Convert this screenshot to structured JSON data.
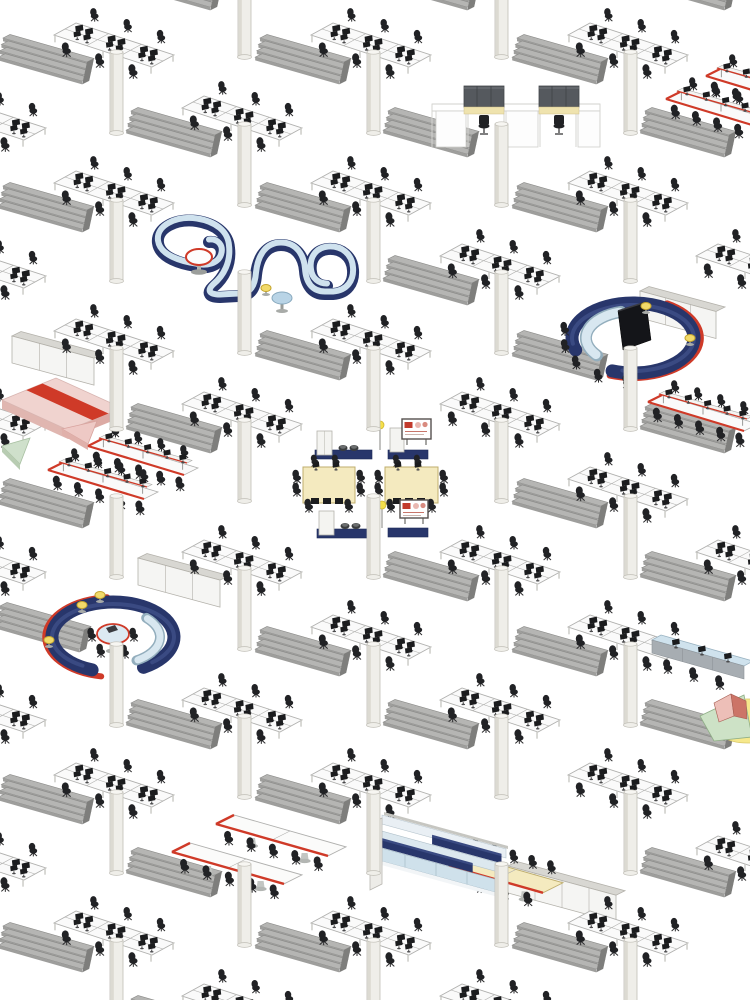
{
  "canvas": {
    "w": 750,
    "h": 1000,
    "bg": "#ffffff"
  },
  "palette": {
    "shelf_top": "#b5b5b3",
    "shelf_front": "#9e9e9c",
    "shelf_cap": "#7e7e7c",
    "shelf_stroke": "#8a8a88",
    "desk_top": "#fafafa",
    "desk_stroke": "#b0b0ae",
    "leg": "#c8c8c4",
    "monitor": "#1b1c1e",
    "chair": "#212225",
    "column_body": "#efeee9",
    "column_shade": "#dcdad2",
    "column_stroke": "#c0beb6",
    "column_top": "#f7f6f2",
    "navy": "#28366b",
    "navy_dark": "#1d2a57",
    "navy_top": "#3a4a82",
    "seat_blue": "#cfe2ed",
    "seat_edge": "#93aebd",
    "seat_light": "#d8e7f0",
    "red": "#cf3a28",
    "cream": "#f4eabf",
    "cream_stroke": "#bfae6e",
    "cabinet_front": "#f5f5f3",
    "cabinet_top": "#d8d7d2",
    "cabinet_stroke": "#b3b1aa",
    "stool_yellow": "#f2da6a",
    "stool_stroke": "#c4a52f",
    "booth_panel": "#55595e",
    "booth_stripe": "#efe3ae",
    "pink": "#f0d3cf",
    "pink_side": "#e0b6b0",
    "green": "#cfe0cb",
    "screen": "#141519",
    "display_red": "#c23b2d",
    "display_pink": "#e9b7b0",
    "lamp": "#f5e04a",
    "bleach_face": "#cfe1eb",
    "bleach_top": "#e9eff4",
    "bleach_mid": "#dce8ef",
    "gray_cap": "#c6c6c1",
    "counter_front": "#a7adb2"
  },
  "scene": {
    "clusters": [
      [
        -14,
        118
      ],
      [
        -14,
        266
      ],
      [
        -14,
        414
      ],
      [
        -14,
        562
      ],
      [
        -14,
        710
      ],
      [
        -14,
        858
      ],
      [
        114,
        45
      ],
      [
        114,
        193
      ],
      [
        114,
        341
      ],
      [
        114,
        785
      ],
      [
        114,
        933
      ],
      [
        242,
        118
      ],
      [
        242,
        414
      ],
      [
        242,
        562
      ],
      [
        242,
        710
      ],
      [
        242,
        1006
      ],
      [
        371,
        45
      ],
      [
        371,
        193
      ],
      [
        371,
        341
      ],
      [
        371,
        637
      ],
      [
        371,
        785
      ],
      [
        371,
        933
      ],
      [
        500,
        266
      ],
      [
        500,
        414
      ],
      [
        500,
        562
      ],
      [
        500,
        710
      ],
      [
        500,
        1006
      ],
      [
        628,
        45
      ],
      [
        628,
        193
      ],
      [
        628,
        489
      ],
      [
        628,
        637
      ],
      [
        628,
        785
      ],
      [
        628,
        933
      ],
      [
        756,
        266
      ],
      [
        756,
        562
      ],
      [
        756,
        858
      ]
    ],
    "shelves": [
      [
        3,
        38
      ],
      [
        3,
        186
      ],
      [
        3,
        482
      ],
      [
        0,
        606
      ],
      [
        3,
        778
      ],
      [
        3,
        926
      ],
      [
        131,
        -36
      ],
      [
        131,
        111
      ],
      [
        131,
        407
      ],
      [
        131,
        703
      ],
      [
        131,
        851
      ],
      [
        131,
        999
      ],
      [
        260,
        38
      ],
      [
        260,
        186
      ],
      [
        260,
        334
      ],
      [
        260,
        630
      ],
      [
        260,
        778
      ],
      [
        260,
        926
      ],
      [
        388,
        -36
      ],
      [
        388,
        111
      ],
      [
        388,
        259
      ],
      [
        388,
        555
      ],
      [
        388,
        703
      ],
      [
        517,
        38
      ],
      [
        517,
        186
      ],
      [
        517,
        334
      ],
      [
        517,
        482
      ],
      [
        517,
        630
      ],
      [
        517,
        926
      ],
      [
        645,
        -36
      ],
      [
        645,
        111
      ],
      [
        645,
        407
      ],
      [
        645,
        555
      ],
      [
        645,
        703
      ],
      [
        645,
        851
      ]
    ],
    "columns": [
      [
        110,
        50
      ],
      [
        110,
        198
      ],
      [
        110,
        346
      ],
      [
        110,
        494
      ],
      [
        110,
        642
      ],
      [
        110,
        790
      ],
      [
        110,
        938
      ],
      [
        238,
        -26
      ],
      [
        238,
        122
      ],
      [
        238,
        270
      ],
      [
        238,
        418
      ],
      [
        238,
        566
      ],
      [
        238,
        714
      ],
      [
        238,
        862
      ],
      [
        367,
        50
      ],
      [
        367,
        198
      ],
      [
        367,
        346
      ],
      [
        367,
        494
      ],
      [
        367,
        642
      ],
      [
        367,
        790
      ],
      [
        367,
        938
      ],
      [
        495,
        -26
      ],
      [
        495,
        122
      ],
      [
        495,
        270
      ],
      [
        495,
        418
      ],
      [
        495,
        566
      ],
      [
        495,
        714
      ],
      [
        495,
        862
      ],
      [
        624,
        50
      ],
      [
        624,
        198
      ],
      [
        624,
        346
      ],
      [
        624,
        494
      ],
      [
        624,
        642
      ],
      [
        624,
        790
      ],
      [
        624,
        938
      ]
    ],
    "cabinets": [
      {
        "x": 12,
        "y": 336,
        "len": 82
      },
      {
        "x": 138,
        "y": 558,
        "len": 82
      },
      {
        "x": 640,
        "y": 291,
        "len": 76
      },
      {
        "x": 508,
        "y": 866,
        "len": 108
      }
    ],
    "s_sofa": {
      "path": "M 209 242 C 218 241 224 248 221 257 C 218 266 206 269 196 266 C 182 264 160 258 158 243 C 156 228 176 218 197 221 C 216 224 228 234 229 248 C 231 264 224 278 213 287 C 207 293 209 297 220 297 L 238 296 C 251 296 255 288 256 275 C 258 256 267 245 281 245 C 296 245 304 257 305 271 C 306 286 313 294 325 294 L 333 294 C 347 293 354 283 353 270 C 352 256 341 248 328 249 C 316 250 309 260 311 272 C 312 281 319 286 327 286",
      "round_table": [
        199,
        257
      ],
      "yellow_stools": [
        [
          266,
          288
        ]
      ],
      "blue_table": [
        282,
        298
      ]
    },
    "ring_right": {
      "cx": 633,
      "cy": 338,
      "rx": 61,
      "ry": 35,
      "screen": [
        [
          618,
          311
        ],
        [
          646,
          302
        ],
        [
          651,
          340
        ],
        [
          623,
          350
        ]
      ],
      "chairs_deg": [
        95,
        120,
        145,
        168,
        190
      ],
      "stools": [
        [
          646,
          306
        ],
        [
          690,
          338
        ]
      ]
    },
    "ring_left": {
      "cx": 113,
      "cy": 637,
      "rx": 61,
      "ry": 35,
      "table": [
        113,
        634
      ],
      "chairs": [
        [
          92,
          636
        ],
        [
          134,
          636
        ],
        [
          101,
          652
        ],
        [
          125,
          653
        ]
      ],
      "stools": [
        [
          100,
          595
        ],
        [
          82,
          605
        ],
        [
          49,
          640
        ]
      ]
    },
    "booths": {
      "x": 428,
      "y": 84,
      "units": [
        464,
        539
      ]
    },
    "conference": {
      "x": 295,
      "y": 418
    },
    "red_benches": [
      [
        88,
        446
      ],
      [
        48,
        470
      ],
      [
        706,
        76
      ],
      [
        666,
        99
      ],
      [
        648,
        402
      ]
    ],
    "plain_red_tables": [
      {
        "x": 216,
        "y": 824,
        "len": 112,
        "dep": 18,
        "fill": "#fbfbfa",
        "chairs_top": false
      },
      {
        "x": 172,
        "y": 852,
        "len": 112,
        "dep": 18,
        "fill": "#fbfbfa",
        "chairs_top": false
      },
      {
        "x": 449,
        "y": 866,
        "len": 94,
        "dep": 20,
        "fill": "#f4eabf",
        "chairs_top": true
      }
    ],
    "bleacher": {
      "x": 376,
      "y": 812
    },
    "bar_counter": {
      "x": 652,
      "y": 640
    },
    "mats": {
      "x": 2,
      "y": 376
    },
    "tent": {
      "x": 700,
      "y": 690
    }
  }
}
